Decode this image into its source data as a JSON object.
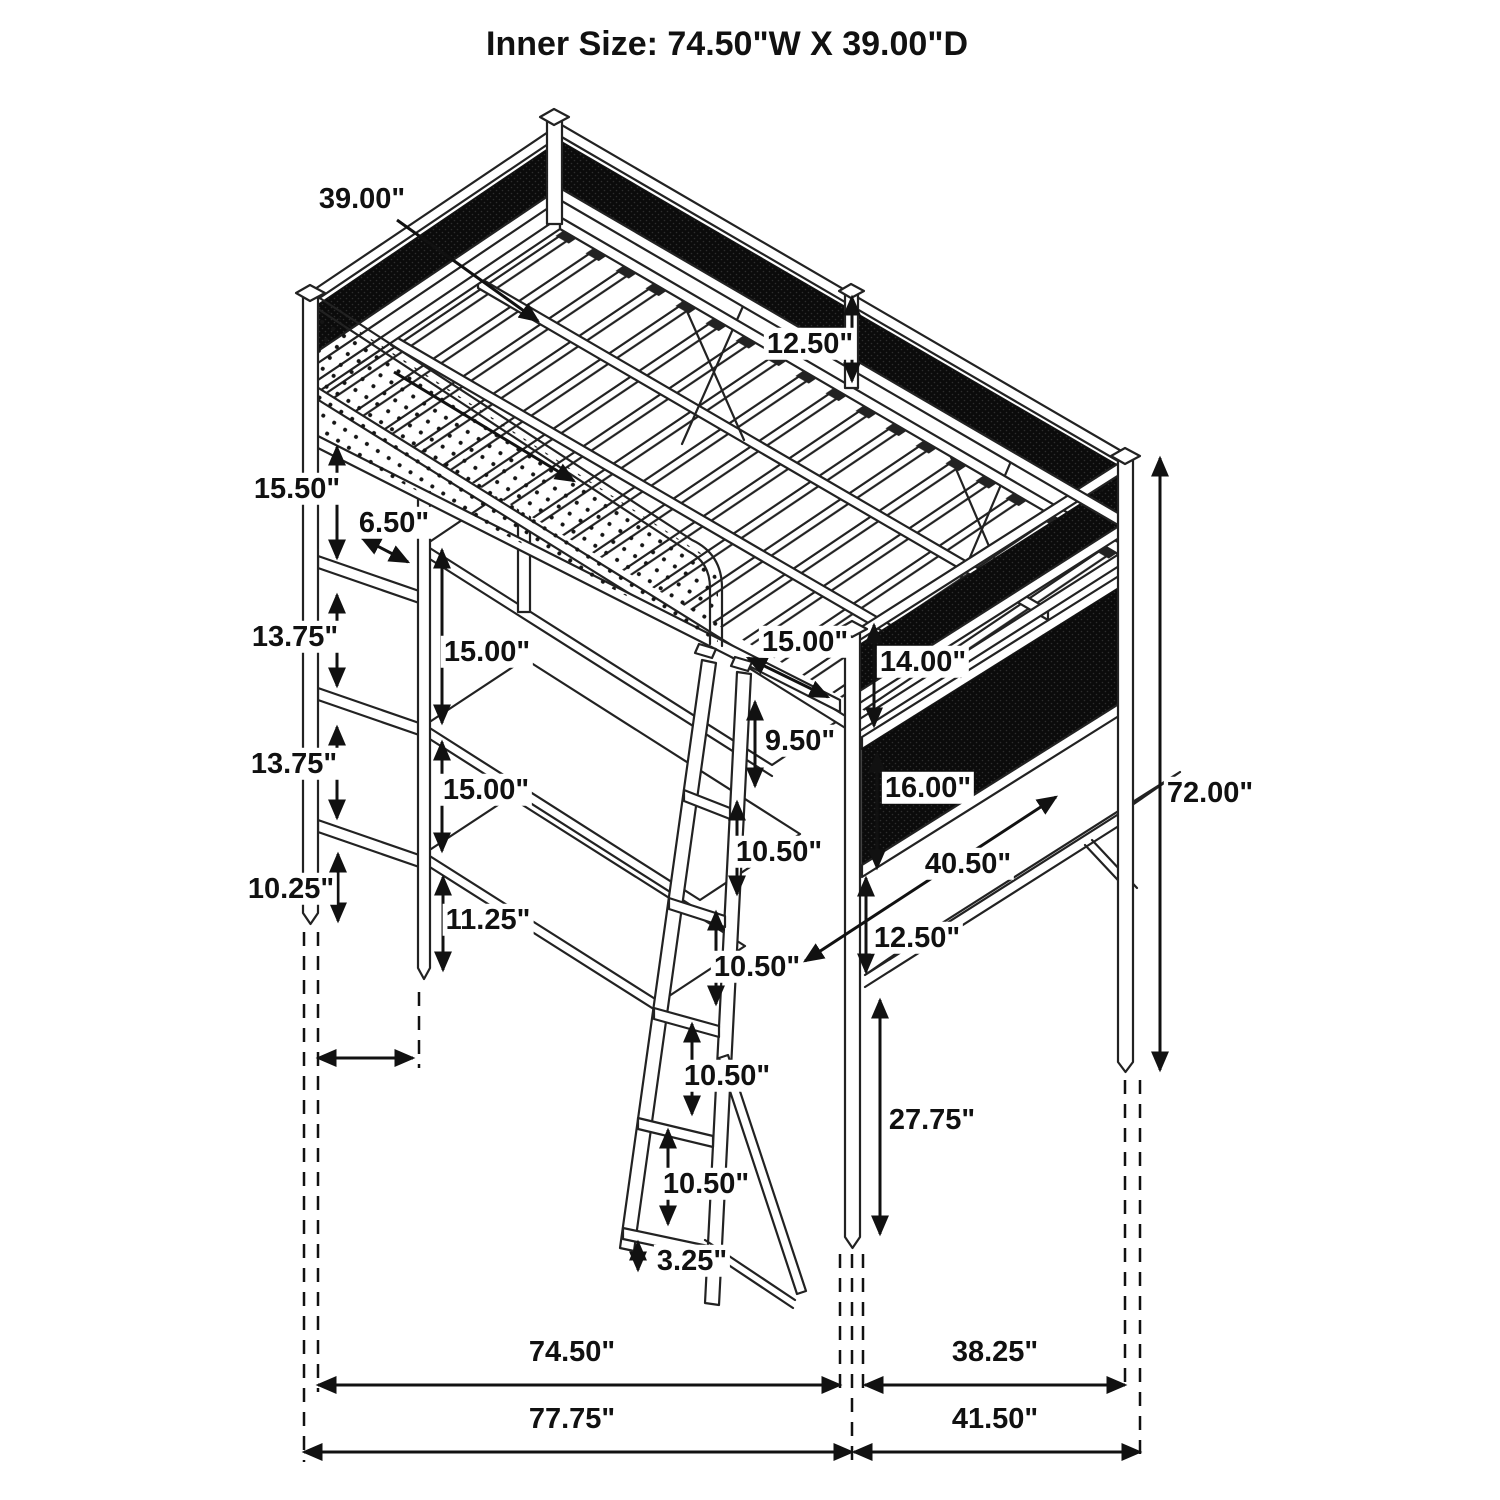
{
  "title": "Inner Size: 74.50\"W X 39.00\"D",
  "colors": {
    "line": "#222222",
    "mesh_panel": "#0b0b0b",
    "background": "#ffffff",
    "label_text": "#111111"
  },
  "dims": {
    "d39": "39.00\"",
    "d1250_guard": "12.50\"",
    "d1550": "15.50\"",
    "d650": "6.50\"",
    "d1375a": "13.75\"",
    "d1375b": "13.75\"",
    "d1500a": "15.00\"",
    "d1500b": "15.00\"",
    "d1025": "10.25\"",
    "d1125": "11.25\"",
    "d1500c": "15.00\"",
    "d1400": "14.00\"",
    "d950": "9.50\"",
    "d1600": "16.00\"",
    "d1050a": "10.50\"",
    "d4050": "40.50\"",
    "d1250_right": "12.50\"",
    "d1050b": "10.50\"",
    "d1050c": "10.50\"",
    "d1050d": "10.50\"",
    "d325": "3.25\"",
    "d2775": "27.75\"",
    "d7200": "72.00\"",
    "d7450": "74.50\"",
    "d3825": "38.25\"",
    "d7775": "77.75\"",
    "d4150": "41.50\""
  }
}
